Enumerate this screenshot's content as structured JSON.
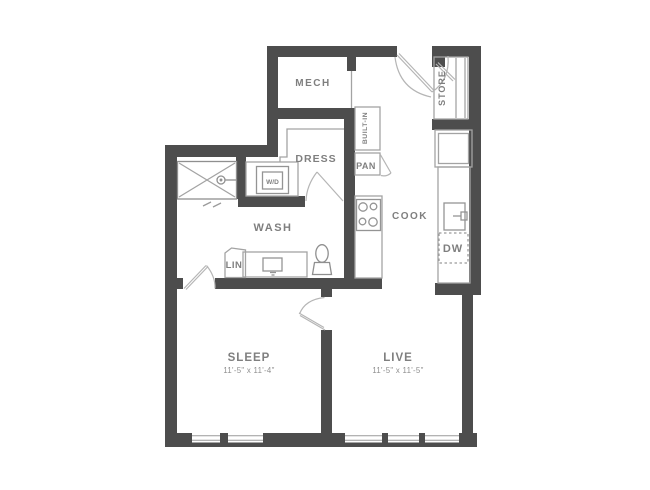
{
  "plan": {
    "title": "Apartment floor plan",
    "labels": {
      "mech": "MECH",
      "store": "STORE",
      "built_in": "BUILT-IN",
      "dress": "DRESS",
      "pan": "PAN",
      "wd": "W/D",
      "wash": "WASH",
      "cook": "COOK",
      "dw": "DW",
      "lin": "LIN",
      "sleep": "SLEEP",
      "live": "LIVE"
    },
    "dimensions": {
      "sleep": "11'-5\" x 11'-4\"",
      "live": "11'-5\" x 11'-5\""
    },
    "colors": {
      "wall": "#4d4d4d",
      "fixture_line": "#a3a3a3",
      "door_line": "#b5b5b5",
      "label_text": "#7f7f7f",
      "dim_text": "#8f8f8f",
      "background": "#ffffff"
    }
  }
}
